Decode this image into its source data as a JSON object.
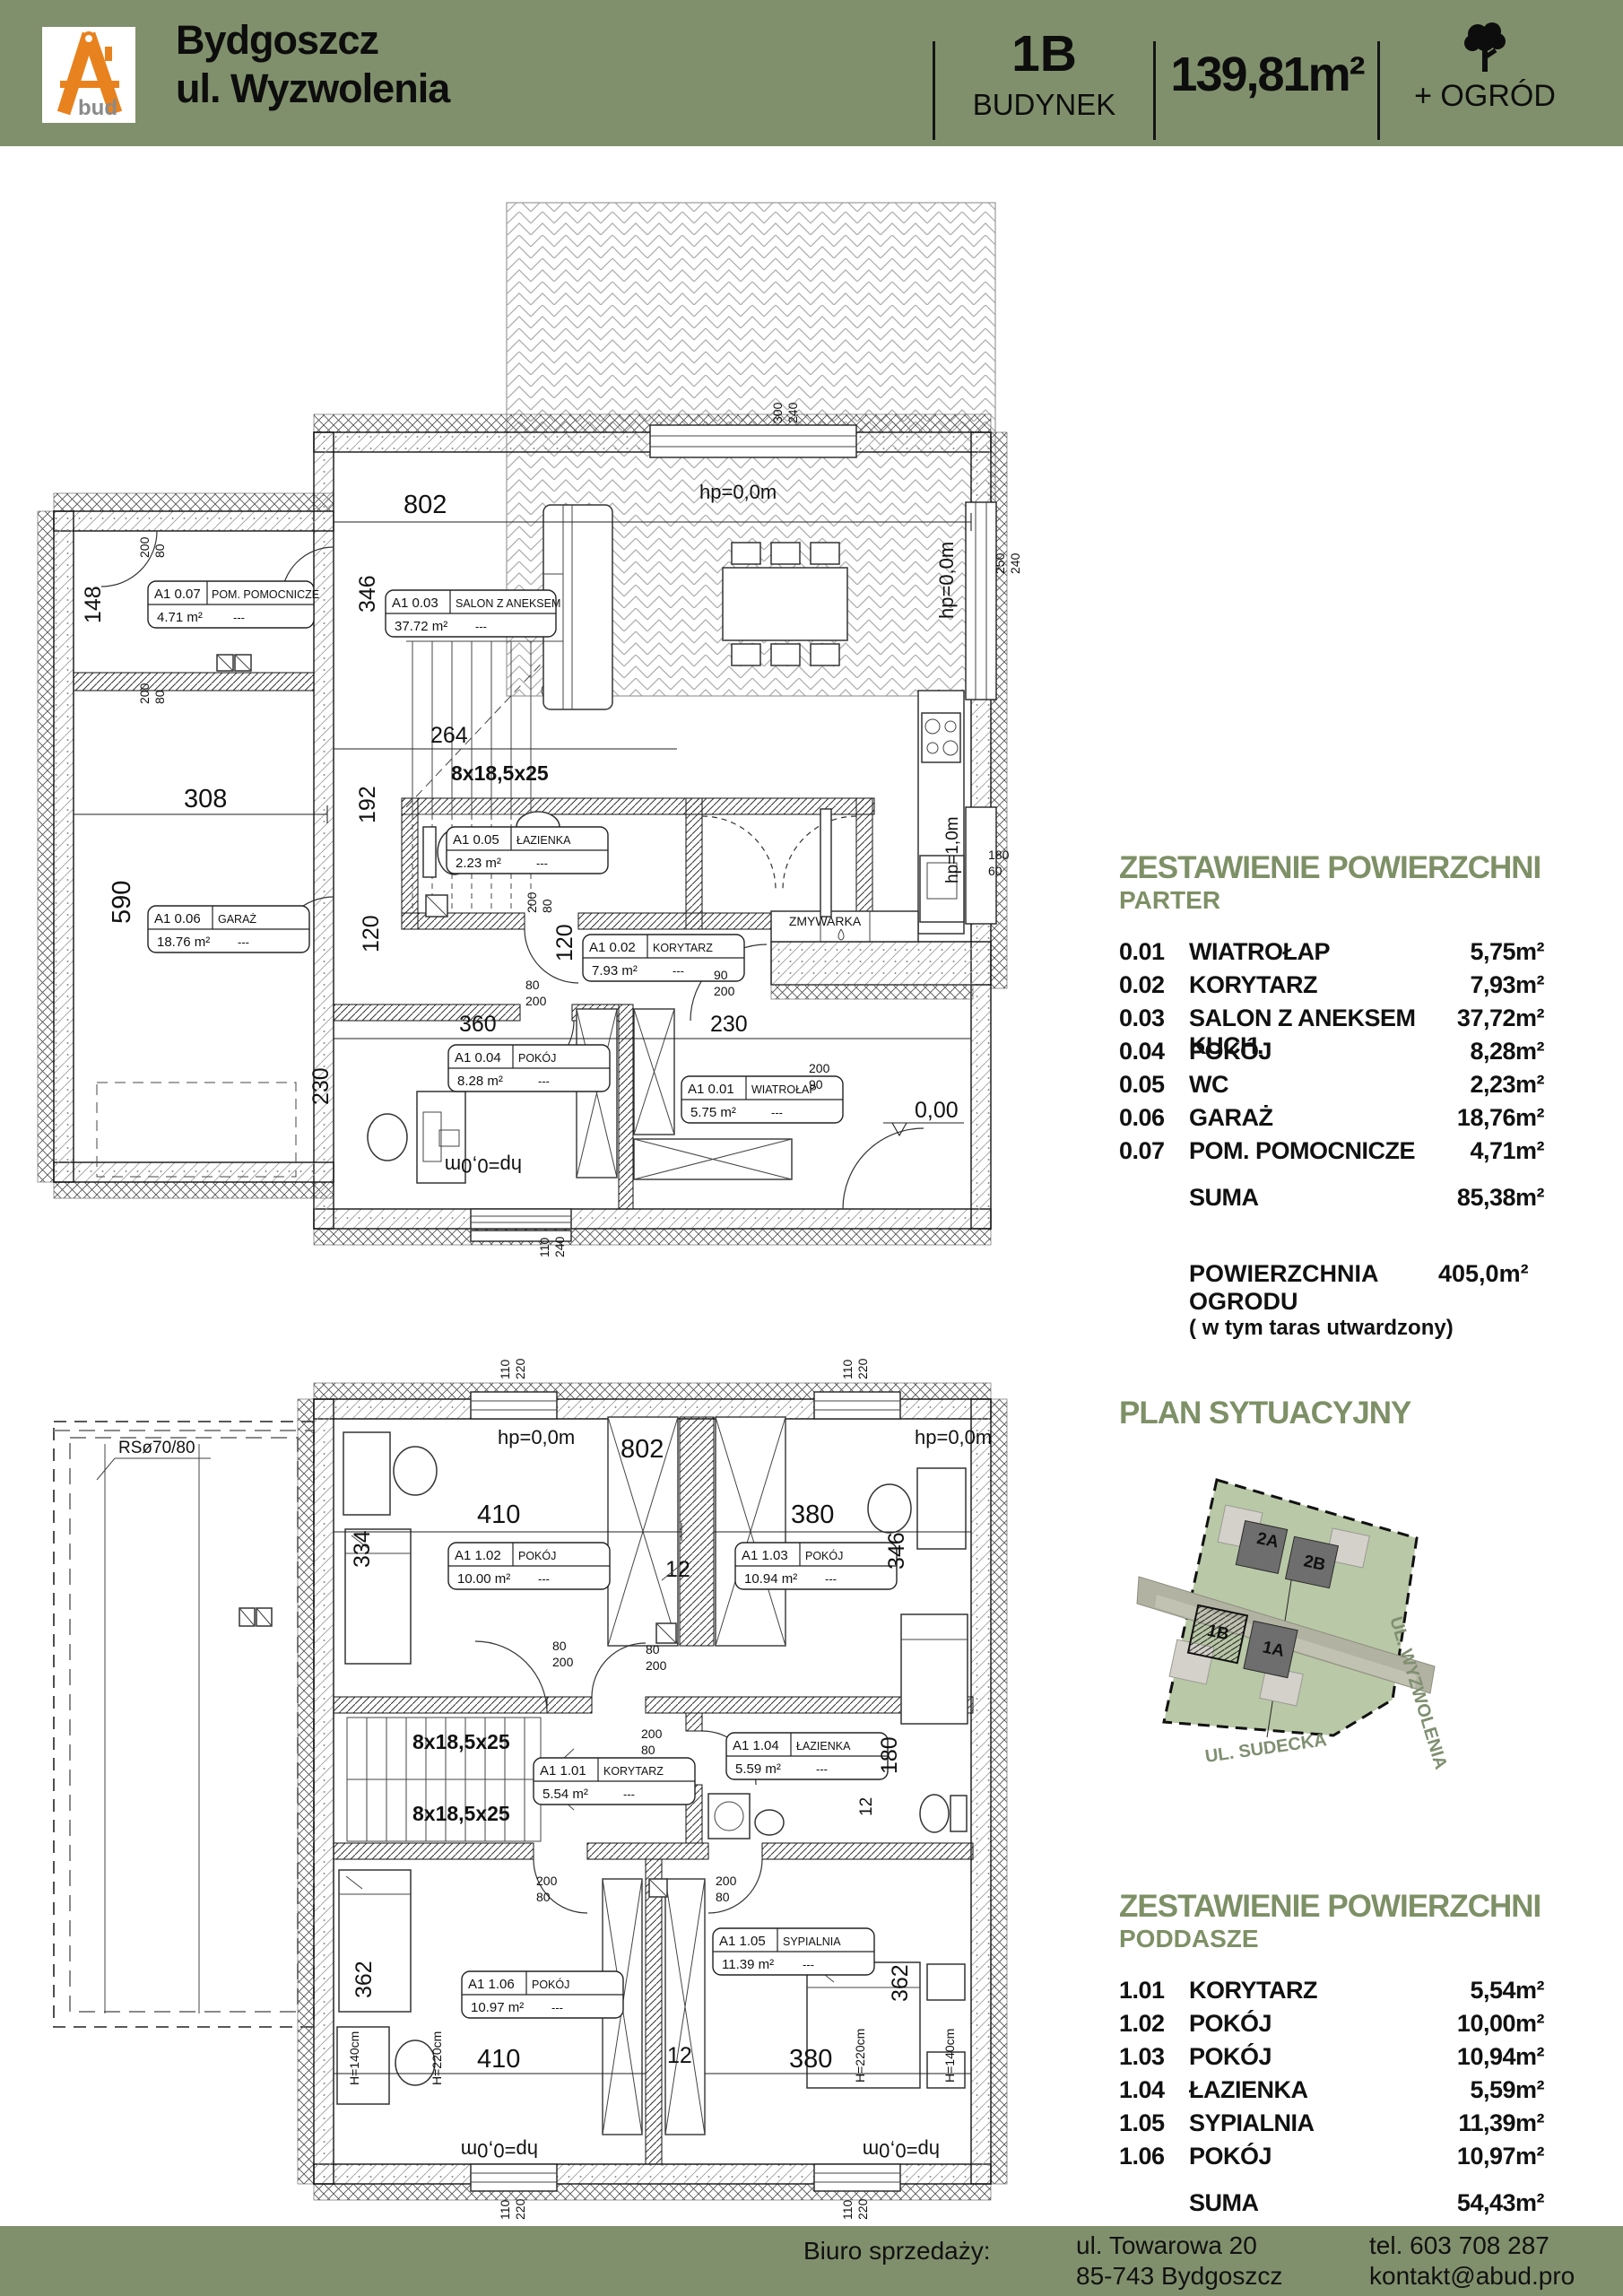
{
  "colors": {
    "bar_green": "#80906c",
    "heading_green": "#7e9066",
    "logo_orange": "#e8821e",
    "parcel_green": "#b9c8a6",
    "road_gray": "#b2b2a2",
    "building_gray": "#6e6e6e",
    "terrace_gray": "#d4d1ca"
  },
  "header": {
    "brand_line1": "Bydgoszcz",
    "brand_line2": "ul. Wyzwolenia",
    "logo_text": "bud",
    "unit_id": "1B",
    "unit_label": "BUDYNEK",
    "area_total": "139,81m²",
    "garden": "+ OGRÓD"
  },
  "tables": {
    "parter": {
      "title": "ZESTAWIENIE POWIERZCHNI",
      "subtitle": "PARTER",
      "rows": [
        {
          "no": "0.01",
          "name": "WIATROŁAP",
          "area": "5,75m²"
        },
        {
          "no": "0.02",
          "name": "KORYTARZ",
          "area": "7,93m²"
        },
        {
          "no": "0.03",
          "name": "SALON Z ANEKSEM KUCH.",
          "area": "37,72m²"
        },
        {
          "no": "0.04",
          "name": "POKÓJ",
          "area": "8,28m²"
        },
        {
          "no": "0.05",
          "name": "WC",
          "area": "2,23m²"
        },
        {
          "no": "0.06",
          "name": "GARAŻ",
          "area": "18,76m²"
        },
        {
          "no": "0.07",
          "name": "POM. POMOCNICZE",
          "area": "4,71m²"
        }
      ],
      "suma_label": "SUMA",
      "suma_value": "85,38m²",
      "garden_label": "POWIERZCHNIA OGRODU",
      "garden_value": "405,0m²",
      "garden_note": "( w tym taras utwardzony)"
    },
    "poddasze": {
      "title": "ZESTAWIENIE POWIERZCHNI",
      "subtitle": "PODDASZE",
      "rows": [
        {
          "no": "1.01",
          "name": "KORYTARZ",
          "area": "5,54m²"
        },
        {
          "no": "1.02",
          "name": "POKÓJ",
          "area": "10,00m²"
        },
        {
          "no": "1.03",
          "name": "POKÓJ",
          "area": "10,94m²"
        },
        {
          "no": "1.04",
          "name": "ŁAZIENKA",
          "area": "5,59m²"
        },
        {
          "no": "1.05",
          "name": "SYPIALNIA",
          "area": "11,39m²"
        },
        {
          "no": "1.06",
          "name": "POKÓJ",
          "area": "10,97m²"
        }
      ],
      "suma_label": "SUMA",
      "suma_value": "54,43m²"
    }
  },
  "siteplan": {
    "title": "PLAN SYTUACYJNY",
    "b2a": "2A",
    "b2b": "2B",
    "b1b": "1B",
    "b1a": "1A",
    "street_right": "UL. WYZWOLENIA",
    "street_bottom": "UL. SUDECKA"
  },
  "footer": {
    "office_label": "Biuro sprzedaży:",
    "addr1": "ul. Towarowa 20",
    "addr2": "85-743 Bydgoszcz",
    "phone": "tel. 603 708 287",
    "email": "kontakt@abud.pro"
  },
  "dims": {
    "d200": "200",
    "d80": "80",
    "d90": "90",
    "d110": "110",
    "d220": "220",
    "d240": "240",
    "d300": "300",
    "d250": "250",
    "d180": "180",
    "d60": "60",
    "d12": "12",
    "hp0": "hp=0,0m",
    "hp1": "hp=1,0m",
    "stairs": "8x18,5x25",
    "h140": "H=140cm",
    "h220": "H=220cm",
    "level0": "0,00",
    "zmywarka": "ZMYWARKA",
    "rs": "RSø70/80",
    "dash": "---"
  },
  "plans": {
    "parter": {
      "rooms": [
        {
          "code": "A1  0.01",
          "name": "WIATROŁAP",
          "area": "5.75  m²"
        },
        {
          "code": "A1  0.02",
          "name": "KORYTARZ",
          "area": "7.93  m²"
        },
        {
          "code": "A1  0.03",
          "name": "SALON Z ANEKSEM",
          "area": "37.72  m²"
        },
        {
          "code": "A1  0.04",
          "name": "POKÓJ",
          "area": "8.28  m²"
        },
        {
          "code": "A1  0.05",
          "name": "ŁAZIENKA",
          "area": "2.23  m²"
        },
        {
          "code": "A1  0.06",
          "name": "GARAŻ",
          "area": "18.76  m²"
        },
        {
          "code": "A1  0.07",
          "name": "POM. POMOCNICZE",
          "area": "4.71  m²"
        }
      ],
      "dims": {
        "w802": "802",
        "w308": "308",
        "h590": "590",
        "h148": "148",
        "h346": "346",
        "h192": "192",
        "w264": "264",
        "h120": "120",
        "w360": "360",
        "w230": "230",
        "h230": "230"
      }
    },
    "poddasze": {
      "rooms": [
        {
          "code": "A1  1.01",
          "name": "KORYTARZ",
          "area": "5.54  m²"
        },
        {
          "code": "A1  1.02",
          "name": "POKÓJ",
          "area": "10.00  m²"
        },
        {
          "code": "A1  1.03",
          "name": "POKÓJ",
          "area": "10.94  m²"
        },
        {
          "code": "A1  1.04",
          "name": "ŁAZIENKA",
          "area": "5.59  m²"
        },
        {
          "code": "A1  1.05",
          "name": "SYPIALNIA",
          "area": "11.39  m²"
        },
        {
          "code": "A1  1.06",
          "name": "POKÓJ",
          "area": "10.97  m²"
        }
      ],
      "dims": {
        "w802": "802",
        "w410": "410",
        "w380": "380",
        "h334": "334",
        "h346": "346",
        "h362": "362",
        "h180": "180"
      }
    }
  }
}
